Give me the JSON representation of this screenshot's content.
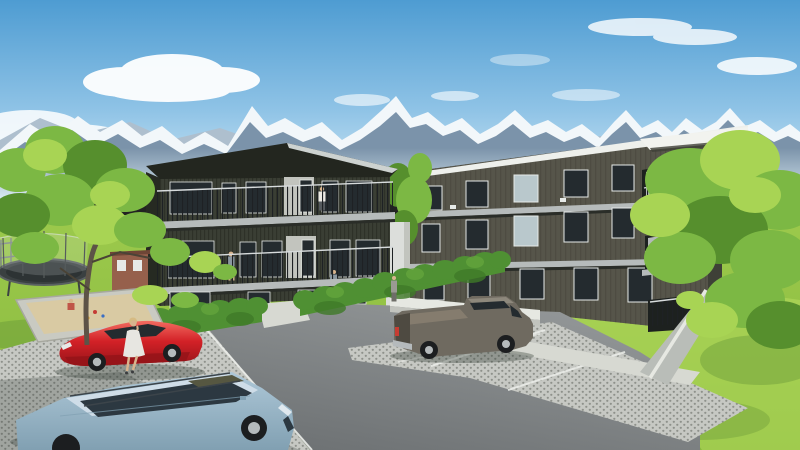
{
  "scene": {
    "title": "Alpine apartment development - exterior visualization",
    "description": "3D architectural rendering of two modern three-storey apartment buildings with dark timber cladding and balconies, set against snow-capped alpine mountains under a blue sky with clouds. A landscaped lawn with trees, a trampoline, a sandbox and a trimmed hedge surrounds a parking area with grass pavers holding a red coupe, a grey pickup truck and a light-blue estate car. A woman walks past the red car and residents stand on the balconies.",
    "labels": {
      "sky": "blue sky",
      "clouds": "white clouds",
      "mountains": "snow-capped mountain range",
      "lawn": "green lawn",
      "left_building": "left apartment building with balconies",
      "right_building": "right apartment building with loggias",
      "stair_core": "white stair core between buildings",
      "hedge": "trimmed hedge",
      "parking": "parking area with grass pavers and asphalt lane",
      "walkway": "concrete walkway",
      "ramp": "ramp with white retaining wall",
      "entrance": "building entrance door",
      "red_car": "red coupe",
      "pickup_truck": "grey pickup truck",
      "estate_car": "light blue estate car",
      "woman": "woman walking past the red car",
      "balcony_residents": "residents on the balconies",
      "entrance_person": "person at the entrance",
      "trampoline": "trampoline with safety net",
      "sandbox": "sandbox with playing child",
      "playhouse": "red playhouse",
      "left_tree": "deciduous tree on the lawn",
      "right_tree": "large deciduous tree",
      "gap_trees": "shrubs between the buildings"
    }
  },
  "colors": {
    "sky_top": "#4e9cd2",
    "sky_mid": "#8fc3e6",
    "sky_low": "#d9edf6",
    "cloud": "#ffffff",
    "mtn_far": "#aebfce",
    "mtn_rock": "#7b93aa",
    "mtn_snow": "#f2f7fa",
    "haze": "#e0f0f7",
    "lawn_top": "#9cc94c",
    "lawn_bottom": "#88b93d",
    "lawn_sun": "#b8dd60",
    "lawn_shadow": "#5d8c33",
    "hedge": "#4f9033",
    "hedge_dark": "#3f7a28",
    "hedge_light": "#67a83d",
    "tree_light": "#a8d454",
    "tree_mid": "#7cb844",
    "tree_dark": "#568f2d",
    "trunk": "#5d5347",
    "branch": "#4a4336",
    "bldgL_wall": "#3a3e34",
    "bldgL_side": "#262a22",
    "bldgL_roof": "#23261f",
    "roof_lit": "#cdd2d0",
    "sidingL": "#24271f",
    "bldgR_wall": "#56554a",
    "bldgR_dark": "#3e4037",
    "sidingR": "#45443a",
    "fascia": "#eef0ec",
    "soffit": "#f2f3ef",
    "slab": "#b6bbbb",
    "slab_shadow": "#2a2d28",
    "glass": "#242b2f",
    "glass_lit": "#b9c8cc",
    "frame": "#e6eae8",
    "rail_dark": "#1e2124",
    "rail_light": "#d7dbdc",
    "screen": "#b4b9b9",
    "core_white": "#dcdedb",
    "wall_white": "#e6e8e2",
    "wall_shade": "#c2c4be",
    "walk": "#d7d9d2",
    "ramp": "#b9bdb8",
    "asphalt": "#95999a",
    "asphalt_dark": "#6e7274",
    "paver": "#c6c8c3",
    "paver_dot": "#8e918b",
    "paver2": "#abaea8",
    "paver2_dot": "#6f726c",
    "line_white": "#eceeea",
    "car_red": "#d32127",
    "car_red_dark": "#951419",
    "car_red_light": "#f26b60",
    "truck_body": "#6f6a60",
    "truck_dark": "#4e4a41",
    "truck_light": "#8d887c",
    "tonneau": "#857c6e",
    "taillight": "#c63c32",
    "wagon_body": "#aec8d8",
    "wagon_dark": "#81a0b2",
    "wagon_roof": "#cfdde8",
    "sunroof": "#565741",
    "win_dark": "#2c3841",
    "tire": "#1c1e20",
    "rim": "#b5babc",
    "skin": "#d8b48e",
    "hair_blonde": "#d6bb83",
    "dress": "#e7e6e1",
    "shirt_white": "#eceae4",
    "shirt_gray": "#8b97a0",
    "pants_dark": "#3f444a",
    "fig_gray": "#9a9a93",
    "house_red": "#96604c",
    "house_roof": "#6e4536",
    "sand": "#d9caa3",
    "sandbox_frame": "#c9cac2",
    "tramp_mat": "#3a4041",
    "tramp_dark": "#2d3334",
    "net": "#dfe5e6",
    "fence": "#7d8587",
    "shadow": "#2e3832"
  }
}
